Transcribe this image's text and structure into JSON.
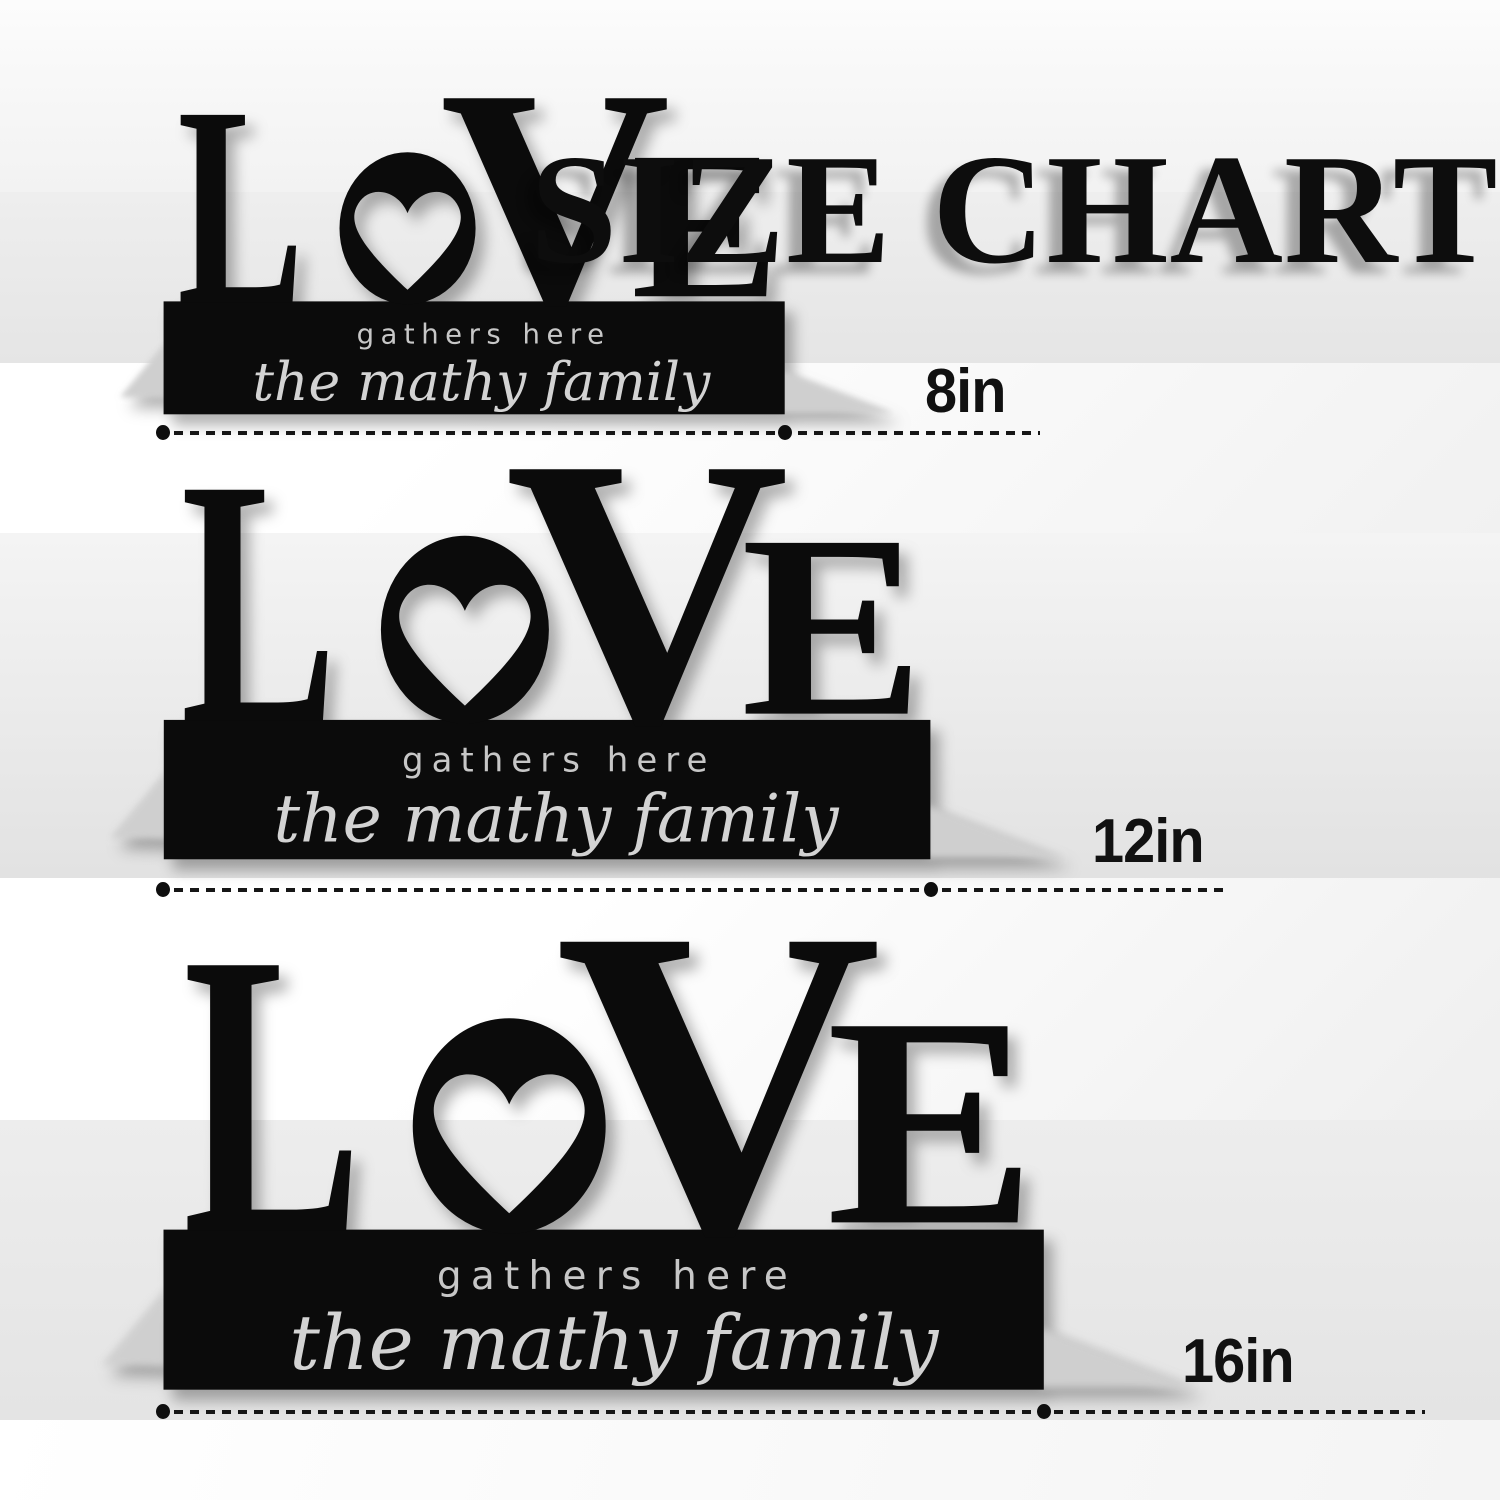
{
  "title": "SIZE CHART",
  "product": {
    "word": "LOVE",
    "letter_l": "L",
    "letter_o": "O",
    "letter_v": "V",
    "letter_e": "E",
    "tagline": "gathers here",
    "family_name": "the mathy family"
  },
  "sizes": [
    {
      "label": "8in"
    },
    {
      "label": "12in"
    },
    {
      "label": "16in"
    }
  ],
  "colors": {
    "panel_black": "#0b0b0b",
    "engraving_silver": "#cccccc",
    "title_ink": "#0d0d0d",
    "band_gray": "#e8e8e8",
    "band_white": "#fbfbfb",
    "fold_shadow_gray": "#d6d6d6"
  },
  "icons": {
    "heart": "heart-cutout"
  }
}
